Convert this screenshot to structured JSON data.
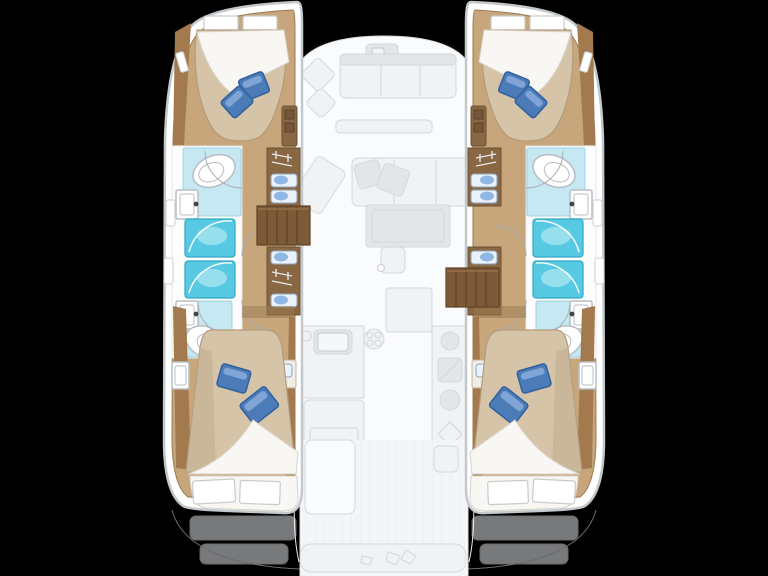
{
  "labels": {
    "plan": "catamaran-4-cabin-floor-plan",
    "port_hull": "port-hull",
    "starboard_hull": "starboard-hull",
    "saloon_deck": "central-saloon-and-cockpit-deck"
  },
  "counts": {
    "hulls": 2,
    "double_cabins": 4,
    "bathrooms": 4,
    "showers": 4,
    "companionway_steps": 2
  },
  "fixtures": [
    "double-bed",
    "white-head-pillows",
    "blue-deco-pillows",
    "folded-sheet",
    "toilet",
    "washbasin",
    "shower-stall",
    "vanity-with-twin-sinks",
    "wardrobe-lockers",
    "companionway-steps",
    "hull-portlight",
    "forward-lounge",
    "forward-table",
    "saloon-sofa",
    "sofa-pillows",
    "chart-seat",
    "saloon-table",
    "sideboard",
    "galley-sink",
    "stove-burners",
    "galley-counter",
    "cockpit-table",
    "helm-seat",
    "stern-bench",
    "transom-steps"
  ],
  "colors": {
    "bg": "#000000",
    "hullFill": "#ffffff",
    "hullStroke": "#c3c8cc",
    "floorWood": "#c7a67c",
    "floorEdge": "#9b7b52",
    "wallWood": "#a3794e",
    "cabinetWood": "#8a6743",
    "cabinetEdge": "#6b5133",
    "stepsWood": "#7d5a38",
    "stepsLine": "#5d4126",
    "duvet": "#d6c4a9",
    "duvetShade": "#c2ad8e",
    "duvetEdge": "#b29c7e",
    "sheet": "#f8f7f3",
    "sheetEdge": "#d8d3c9",
    "pillowBlue": "#4c7cb8",
    "pillowBlueDark": "#31609f",
    "pillowBlueLight": "#8aacd9",
    "bathFloor": "#c5e8f3",
    "bathFloorEdge": "#9ed2e4",
    "shower": "#57c9e2",
    "showerEdge": "#2fa9c6",
    "showerLight": "#aee6f1",
    "fixtureFill": "#ffffff",
    "fixtureStroke": "#b7bdc3",
    "sinkBlue": "#8fb6e4",
    "sinkPale": "#eaf2fb",
    "fadedFill": "#f0f2f4",
    "fadedStroke": "#d4d7db",
    "fadedDark": "#e3e6e9",
    "deckFill": "#fafbfc"
  }
}
